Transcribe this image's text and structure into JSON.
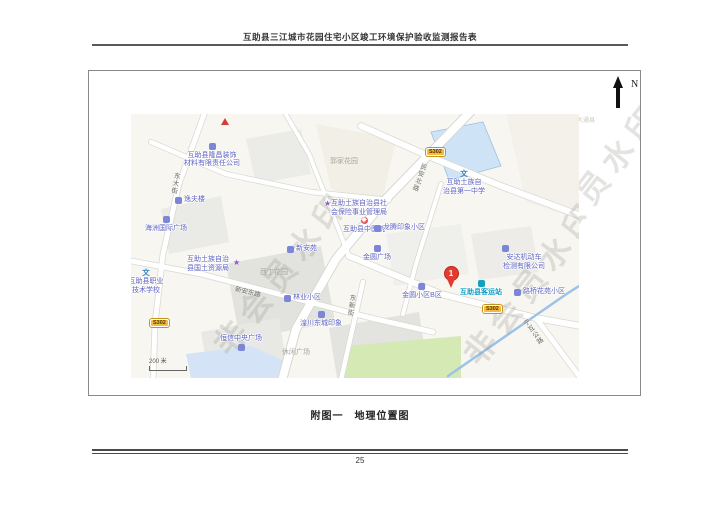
{
  "page": {
    "header_title": "互助县三江城市花园住宅小区竣工环境保护验收监测报告表",
    "caption": "附图一　地理位置图",
    "page_number": "25"
  },
  "compass": {
    "label": "N"
  },
  "icons": {
    "star": "★",
    "school_char": "文",
    "cross": "+"
  },
  "map": {
    "watermark": "非会员水印",
    "scale_label": "200 米",
    "corner_area_label": "大通县",
    "badge_s302": "S302",
    "pin_number": "1",
    "roads": {
      "minan_north": "民安北路",
      "dongda_street": "东大街",
      "dongxin_street": "东新街",
      "xinan_east": "新安东路",
      "ninghu_highway": "宁互公路"
    },
    "areas": {
      "guojia_garden": "郭家花园",
      "xiding_garden": "西丁花园",
      "leisure_square": "休闲广场"
    },
    "pois": {
      "decor_company_l1": "互助县隆昌装饰",
      "decor_company_l2": "材料有限责任公司",
      "yifu_building": "逸夫楼",
      "haizhou_plaza": "海洲国际广场",
      "vocational_school_l1": "互助县职业",
      "vocational_school_l2": "技术学校",
      "land_resources_l1": "互助土族自治",
      "land_resources_l2": "县国土资源局",
      "tcm_hospital": "互助县中医院",
      "social_insurance_l1": "互助土族自治县社",
      "social_insurance_l2": "会保险事业管理局",
      "xinan_yuan": "新安苑",
      "first_middle_school_l1": "互助土族自",
      "first_middle_school_l2": "治县第一中学",
      "longteng_community": "龙腾印象小区",
      "forestry_community": "林业小区",
      "hengxin_plaza": "恒信中央广场",
      "huangchuan_community": "湟川东城印象",
      "jinyuan_plaza": "金圆广场",
      "jinyuan_community_b": "金圆小区B区",
      "bus_station": "互助县客运站",
      "anda_vehicle_l1": "安达机动车",
      "anda_vehicle_l2": "检测有限公司",
      "luqiao_community": "路桥花苑小区"
    }
  }
}
